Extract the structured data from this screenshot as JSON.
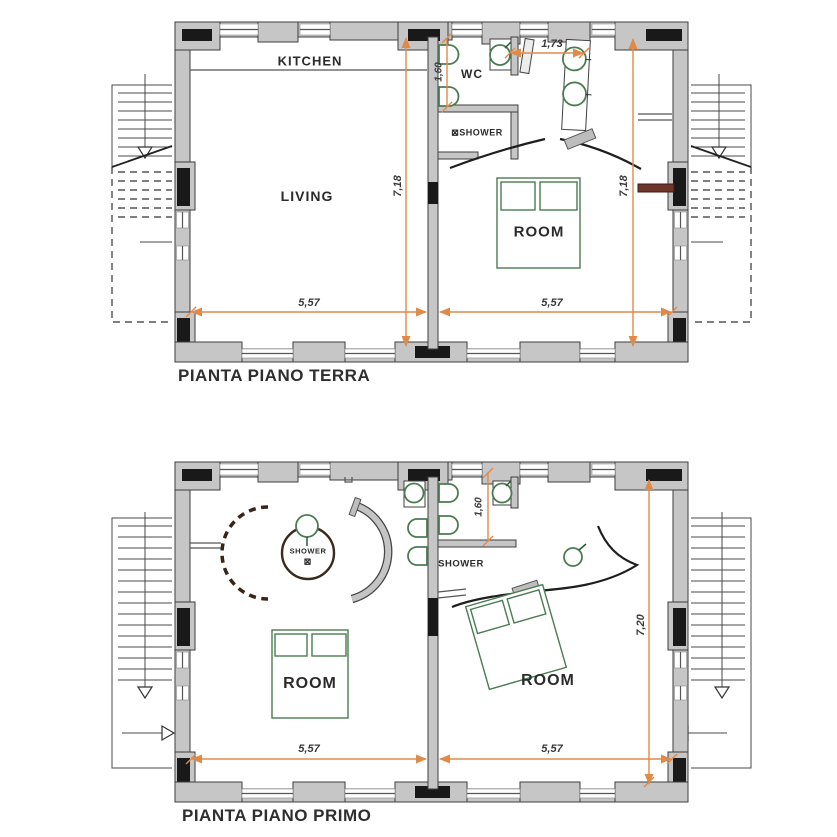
{
  "drawing": {
    "background": "#ffffff",
    "colors": {
      "wall_fill": "#c6c6c6",
      "wall_outline": "#3e3e3e",
      "pillar": "#191919",
      "dimension_line": "#e08a4a",
      "dimension_text": "#3a3a3a",
      "fixture_green": "#4a7c52",
      "curtain_brown": "#3a2417",
      "label_text": "#2b2b2b"
    },
    "ground_floor": {
      "title": "PIANTA PIANO TERRA",
      "labels": {
        "kitchen": "KITCHEN",
        "living": "LIVING",
        "wc": "WC",
        "shower_icon": "⊠",
        "shower": "SHOWER",
        "bedroom": "ROOM"
      },
      "dimensions": {
        "entry_width": "1,73",
        "wc_depth": "1,60",
        "interior_depth_left": "7,18",
        "interior_depth_right": "7,18",
        "interior_width_left": "5,57",
        "interior_width_right": "5,57"
      }
    },
    "first_floor": {
      "title": "PIANTA PIANO PRIMO",
      "labels": {
        "round_shower": "SHOWER",
        "round_shower_icon": "⊠",
        "shower": "SHOWER",
        "bedroom_left": "ROOM",
        "bedroom_right": "ROOM"
      },
      "dimensions": {
        "bathroom_depth": "1,60",
        "interior_depth_right": "7,20",
        "interior_width_left": "5,57",
        "interior_width_right": "5,57"
      }
    }
  }
}
